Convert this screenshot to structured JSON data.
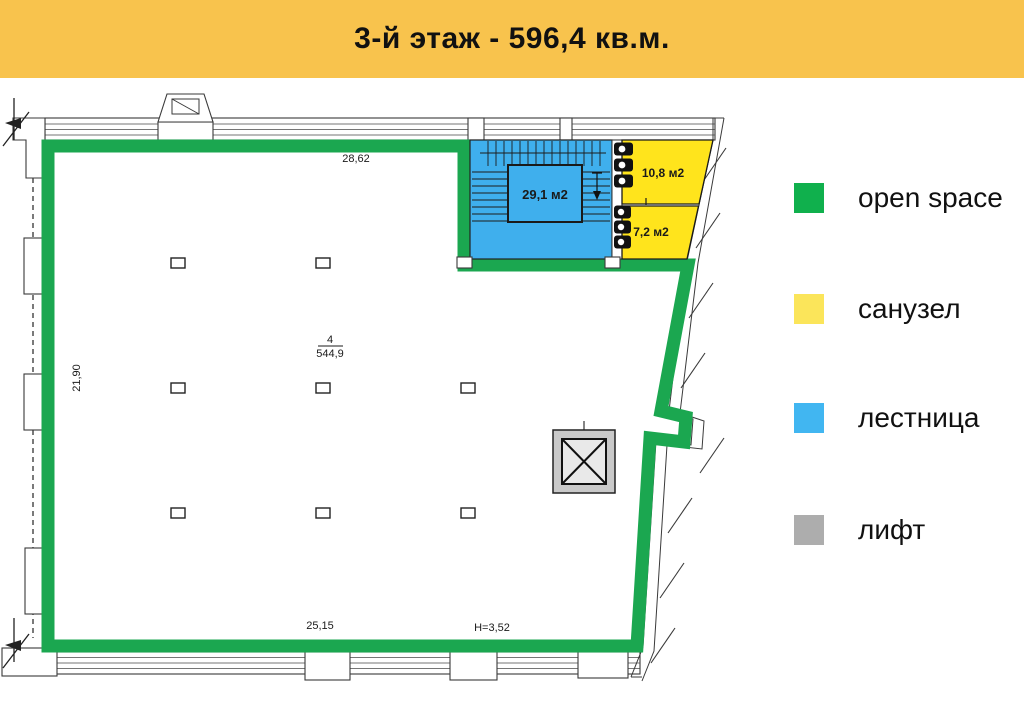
{
  "header": {
    "title": "3-й этаж - 596,4 кв.м."
  },
  "colors": {
    "banner": "#F8C34D",
    "open_space_green": "#1BA750",
    "plan_yellow": "#FFE41C",
    "plan_blue": "#3FAFED",
    "lift_fill": "#C9C9C9",
    "lift_inner": "#E9E9E9",
    "legend_green": "#10B04D",
    "legend_yellow": "#FBE55A",
    "legend_blue": "#41B6F1",
    "legend_gray": "#ADADAD"
  },
  "legend": {
    "items": [
      {
        "key": "open-space",
        "label": "open space",
        "color": "#10B04D"
      },
      {
        "key": "sanuzel",
        "label": "санузел",
        "color": "#FBE55A"
      },
      {
        "key": "lestnitsa",
        "label": "лестница",
        "color": "#41B6F1"
      },
      {
        "key": "lift",
        "label": "лифт",
        "color": "#ADADAD"
      }
    ]
  },
  "plan": {
    "rooms": {
      "open_space": {
        "number": "4",
        "area": "544,9"
      },
      "stairs": {
        "area_label": "29,1 м2"
      },
      "wc_top": {
        "area_label": "10,8 м2"
      },
      "wc_bottom": {
        "area_label": "7,2 м2"
      }
    },
    "dimensions": {
      "top_width": "28,62",
      "left_height": "21,90",
      "bottom_width": "25,15",
      "ceiling_height": "Н=3,52"
    }
  }
}
